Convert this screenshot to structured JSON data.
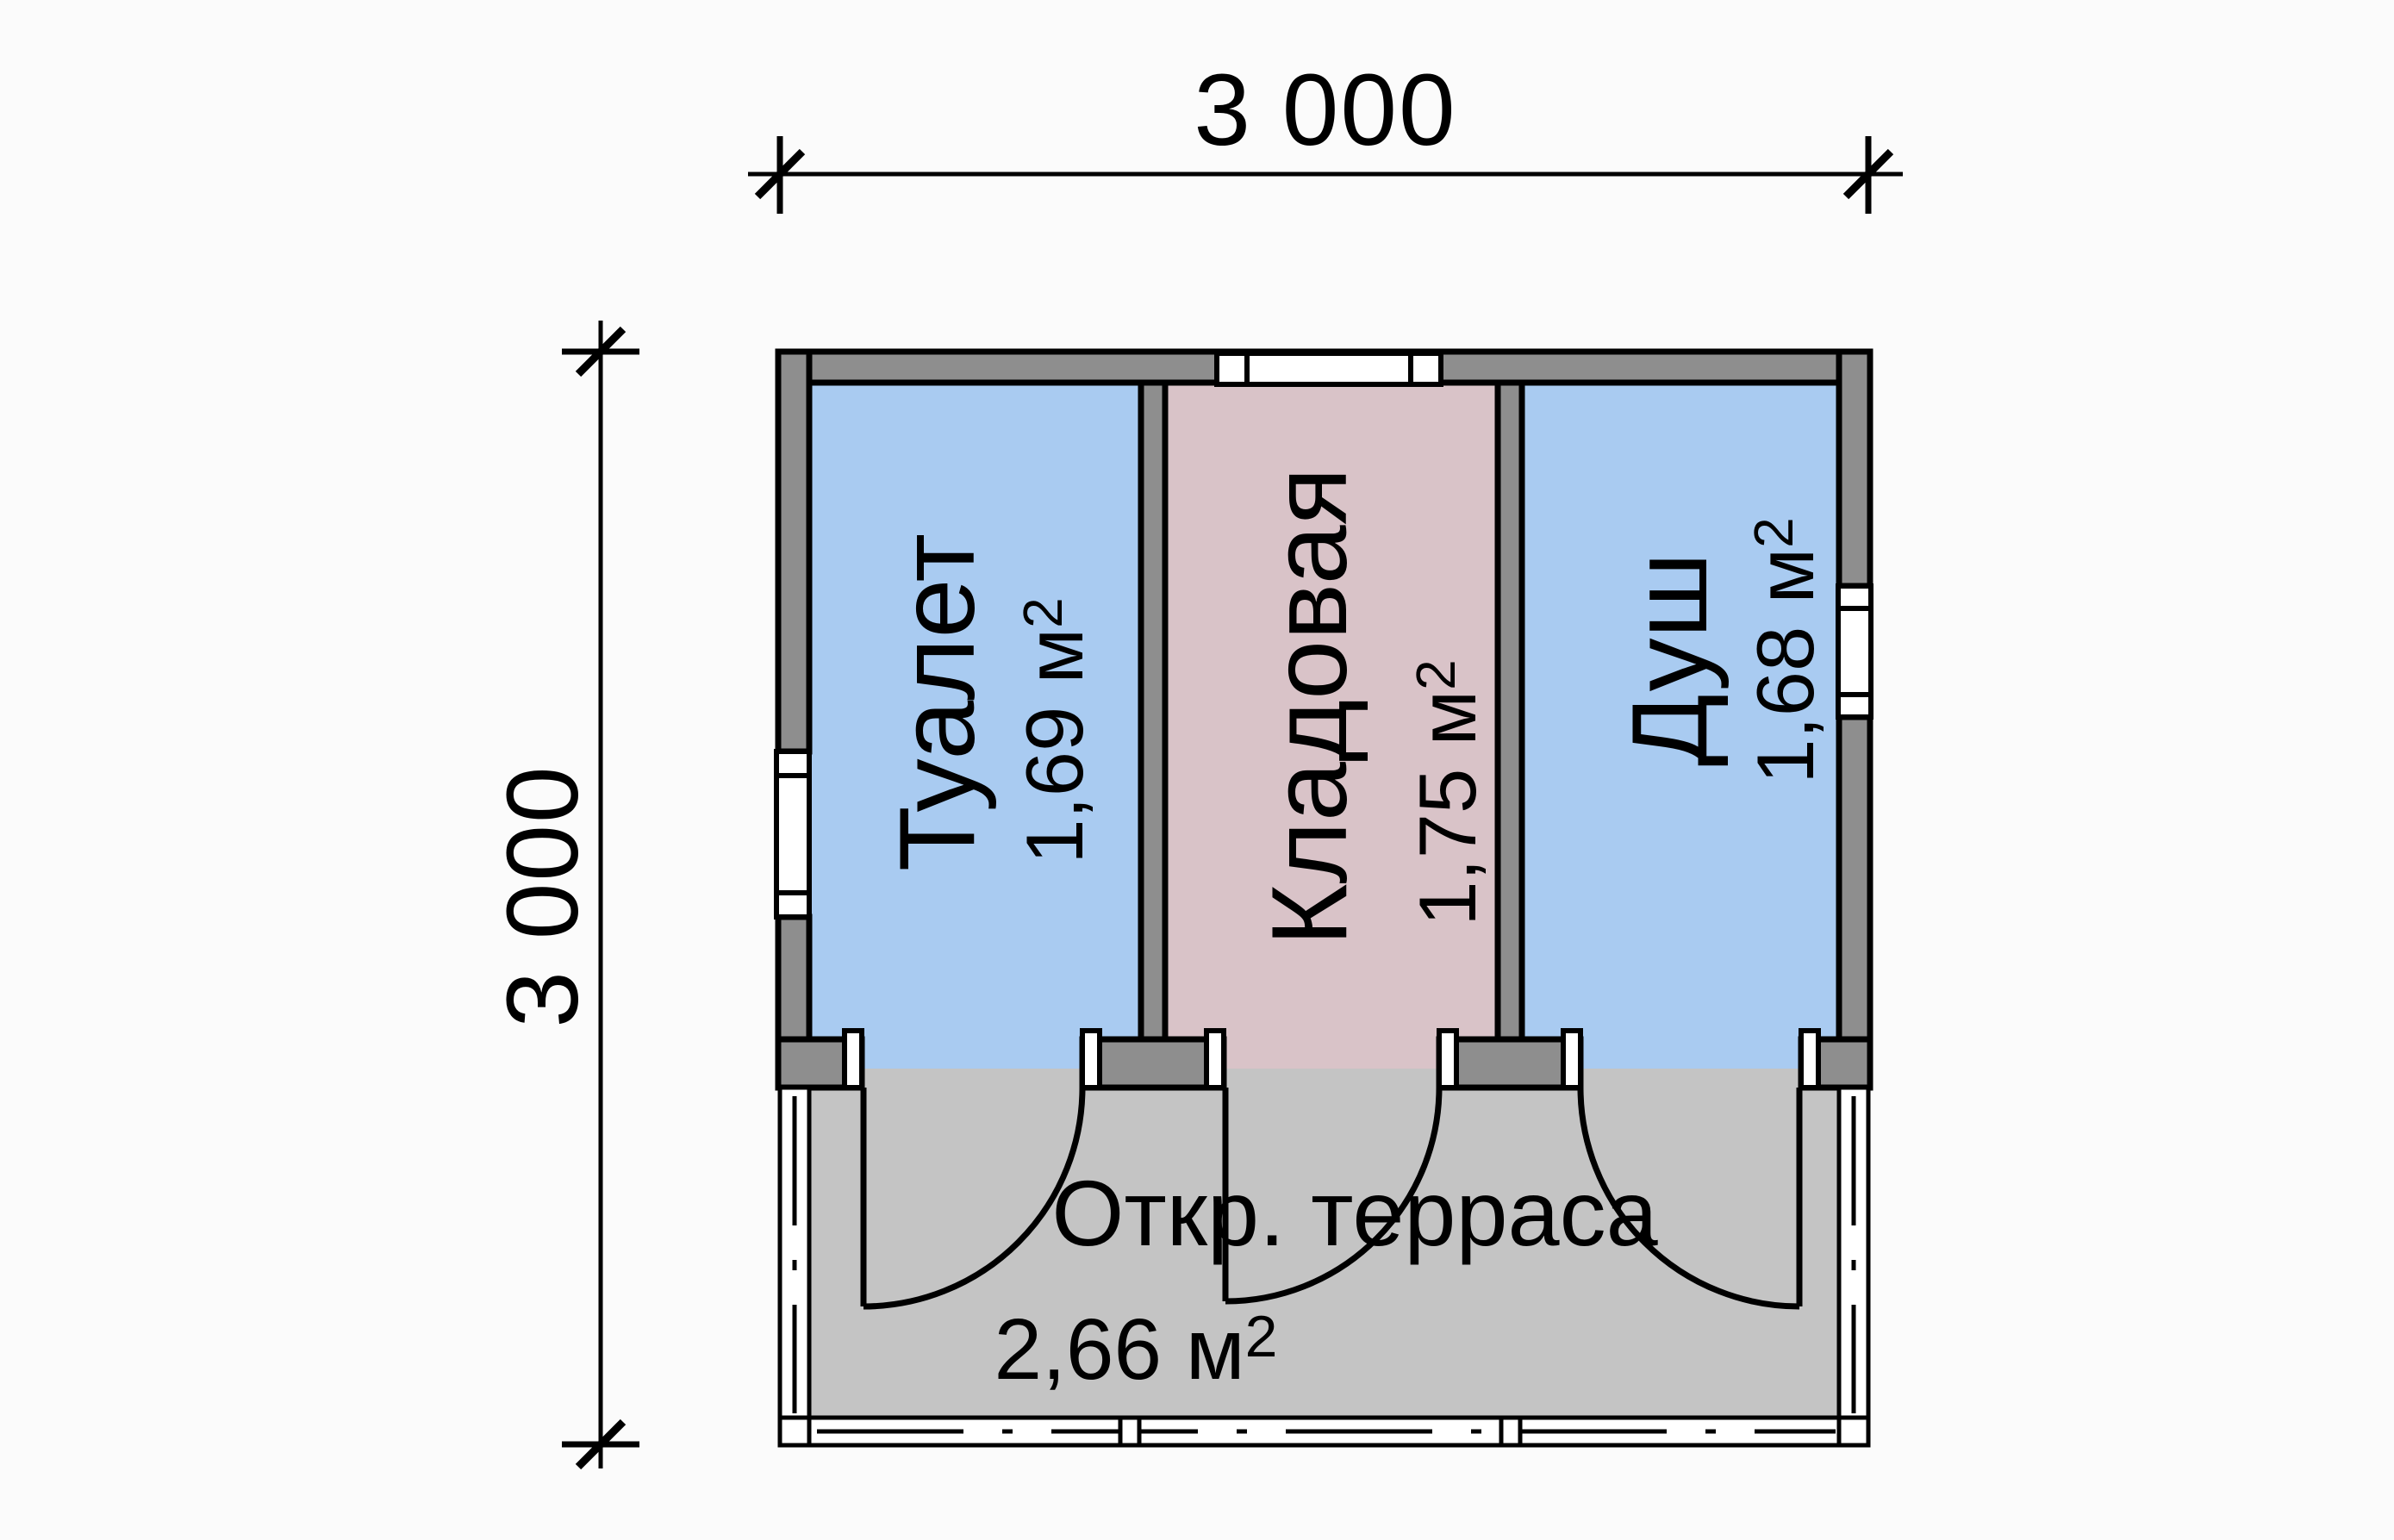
{
  "dimensions": {
    "top": "3 000",
    "left": "3 000"
  },
  "rooms": [
    {
      "name": "Туалет",
      "area_value": "1,69",
      "area_unit": "м",
      "area_exp": "2",
      "fill": "#a9cbf1"
    },
    {
      "name": "Кладовая",
      "area_value": "1,75",
      "area_unit": "м",
      "area_exp": "2",
      "fill": "#d9c3c8"
    },
    {
      "name": "Душ",
      "area_value": "1,68",
      "area_unit": "м",
      "area_exp": "2",
      "fill": "#a9cbf1"
    }
  ],
  "terrace": {
    "name": "Откр. терраса",
    "area_value": "2,66",
    "area_unit": "м",
    "area_exp": "2",
    "fill": "#c4c4c4"
  },
  "colors": {
    "wall": "#8e8e8e",
    "line": "#000000",
    "window": "#ffffff",
    "paper": "#fbfbfb"
  }
}
